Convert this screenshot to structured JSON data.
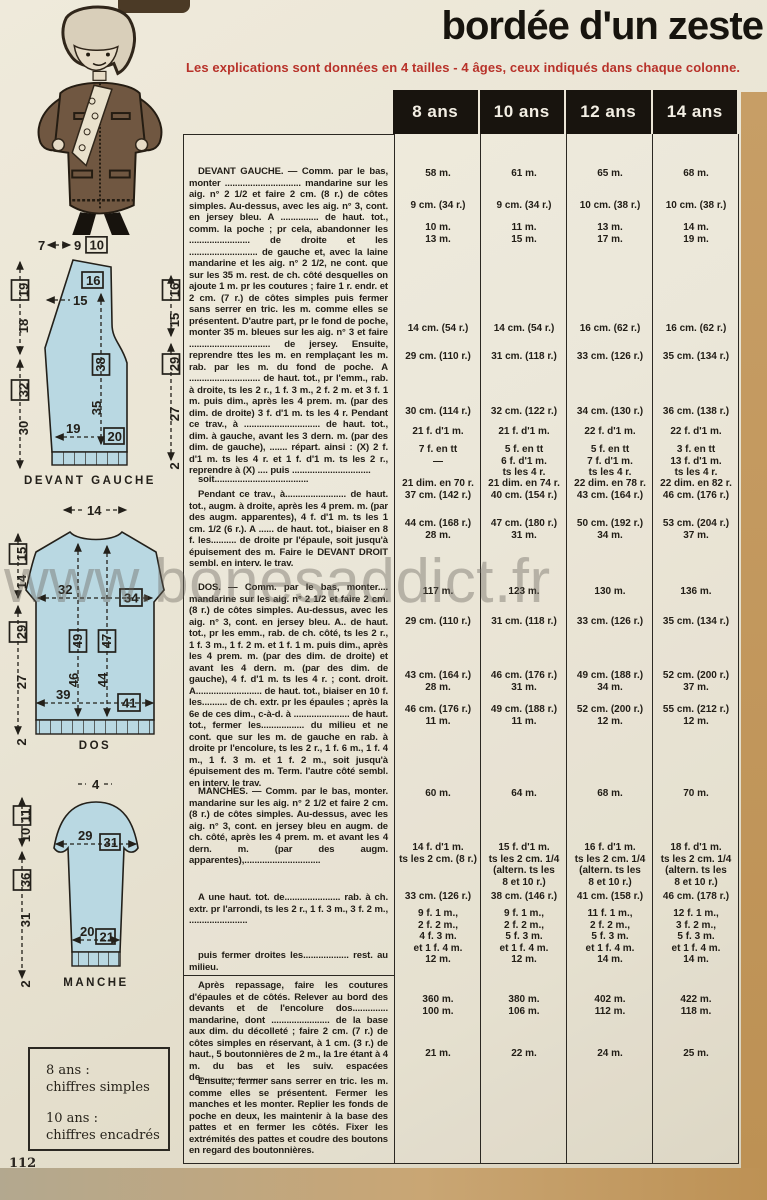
{
  "page": {
    "title": "bordée d'un zeste",
    "subtitle": "Les explications sont données en 4 tailles - 4 âges, ceux indiqués dans chaque colonne.",
    "page_number": "112",
    "watermark": "www.bonesaddict.fr",
    "colors": {
      "accent_red": "#b8322a",
      "header_bg": "#18140e",
      "diagram_blue": "#b9d8e2",
      "paper": "#e9e4d4"
    }
  },
  "table": {
    "headers": [
      "8 ans",
      "10 ans",
      "12 ans",
      "14 ans"
    ],
    "paragraphs": [
      {
        "top": 32,
        "text": "DEVANT GAUCHE. — Comm. par le bas, monter .............................. mandarine sur les aig. n° 2 1/2 et faire 2 cm. (8 r.) de côtes simples. Au-dessus, avec les aig. n° 3, cont. en jersey bleu. A ............... de haut. tot., comm. la poche ; pr cela, abandonner les ........................ de droite et les ........................... de gauche et, avec la laine mandarine et les aig. n° 2 1/2, ne cont. que sur les 35 m. rest. de ch. côté desquelles on ajoute 1 m. pr les coutures ; faire 1 r. endr. et 2 cm. (7 r.) de côtes simples puis fermer sans serrer en tric. les m. comme elles se présentent. D'autre part, pr le fond de poche, monter 35 m. bleues sur les aig. n° 3 et faire ................................ de jersey. Ensuite, reprendre ttes les m. en remplaçant les m. rab. par les m. du fond de poche. A ............................ de haut. tot., pr l'emm., rab. à droite, ts les 2 r., 1 f. 3 m., 2 f. 2 m. et 3 f. 1 m. puis dim., après les 4 prem. m. (par des dim. de droite) 3 f. d'1 m. ts les 4 r. Pendant ce trav., à .............................. de haut. tot., dim. à gauche, avant les 3 dern. m. (par des dim. de gauche), ....... répart. ainsi : (X) 2 f. d'1 m. ts les 4 r. et 1 f. d'1 m. ts les 2 r., reprendre à (X) .... puis ..............................."
      },
      {
        "top": 340,
        "text": "soit....................................."
      },
      {
        "top": 355,
        "text": "Pendant ce trav., à........................ de haut. tot., augm. à droite, après les 4 prem. m. (par des augm. apparentes), 4 f. d'1 m. ts les 1 cm. 1/2 (6 r.). A ...... de haut. tot., biaiser en 8 f. les.......... de droite pr l'épaule, soit jusqu'à épuisement des m. Faire le DEVANT DROIT sembl. en interv. le trav."
      },
      {
        "top": 448,
        "text": "DOS. — Comm. par le bas, monter.... mandarine sur les aig. n° 2 1/2 et faire 2 cm. (8 r.) de côtes simples. Au-dessus, avec les aig. n° 3, cont. en jersey bleu. A.. de haut. tot., pr les emm., rab. de ch. côté, ts les 2 r., 1 f. 3 m., 1 f. 2 m. et 1 f. 1 m. puis dim., après les 4 prem. m. (par des dim. de droite) et avant les 4 dern. m. (par des dim. de gauche), 4 f. d'1 m. ts les 4 r. ; cont. droit. A.......................... de haut. tot., biaiser en 10 f. les.......... de ch. extr. pr les épaules ; après la 6e de ces dim., c-à-d. à ...................... de haut. tot., fermer les................. du milieu et ne cont. que sur les m. de gauche en rab. à droite pr l'encolure, ts les 2 r., 1 f. 6 m., 1 f. 4 m., 1 f. 3 m. et 1 f. 2 m., soit jusqu'à épuisement des m. Term. l'autre côté sembl. en interv. le trav."
      },
      {
        "top": 652,
        "text": "MANCHES. — Comm. par le bas, monter. mandarine sur les aig. n° 2 1/2 et faire 2 cm. (8 r.) de côtes simples. Au-dessus, avec les aig. n° 3, cont. en jersey bleu en augm. de ch. côté, après les 4 prem. m. et avant les 4 dern. m. (par des augm. apparentes),.............................."
      },
      {
        "top": 758,
        "text": "A une haut. tot. de...................... rab. à ch. extr. pr l'arrondi, ts les 2 r., 1 f. 3 m., 3 f. 2 m., ......................."
      },
      {
        "top": 816,
        "text": "puis fermer droites les.................. rest. au milieu."
      },
      {
        "top": 846,
        "text": "Après repassage, faire les coutures d'épaules et de côtés. Relever au bord des devants et de l'encolure dos.............. mandarine, dont ....................... de la base aux dim. du décolleté ; faire 2 cm. (7 r.) de côtes simples en réservant, à 1 cm. (3 r.) de haut., 5 boutonnières de 2 m., la 1re étant à 4 m. du bas et les suiv. espacées de..........................."
      },
      {
        "top": 942,
        "text": "Ensuite, fermer sans serrer en tric. les m. comme elles se présentent. Fermer les manches et les monter. Replier les fonds de poche en deux, les maintenir à la base des pattes et en fermer les côtés. Fixer les extrémités des pattes et coudre des boutons en regard des boutonnières."
      }
    ],
    "divider_top": 841,
    "value_rows": [
      {
        "top": 34,
        "values": [
          "58 m.",
          "61 m.",
          "65 m.",
          "68 m."
        ]
      },
      {
        "top": 66,
        "values": [
          "9 cm. (34 r.)",
          "9 cm. (34 r.)",
          "10 cm. (38 r.)",
          "10 cm. (38 r.)"
        ]
      },
      {
        "top": 88,
        "values": [
          "10 m.\n13 m.",
          "11 m.\n15 m.",
          "13 m.\n17 m.",
          "14 m.\n19 m."
        ]
      },
      {
        "top": 189,
        "values": [
          "14 cm. (54 r.)",
          "14 cm. (54 r.)",
          "16 cm. (62 r.)",
          "16 cm. (62 r.)"
        ]
      },
      {
        "top": 217,
        "values": [
          "29 cm. (110 r.)",
          "31 cm. (118 r.)",
          "33 cm. (126 r.)",
          "35 cm. (134 r.)"
        ]
      },
      {
        "top": 272,
        "values": [
          "30 cm. (114 r.)",
          "32 cm. (122 r.)",
          "34 cm. (130 r.)",
          "36 cm. (138 r.)"
        ]
      },
      {
        "top": 292,
        "values": [
          "21 f. d'1 m.",
          "21 f. d'1 m.",
          "22 f. d'1 m.",
          "22 f. d'1 m."
        ]
      },
      {
        "top": 310,
        "values": [
          "7 f. en tt\n—",
          "5 f. en tt\n6 f. d'1 m.\nts les 4 r.",
          "5 f. en tt\n7 f. d'1 m.\nts les 4 r.",
          "3 f. en tt\n13 f. d'1 m.\nts les 4 r."
        ]
      },
      {
        "top": 344,
        "values": [
          "21 dim. en 70 r.\n37 cm. (142 r.)",
          "21 dim. en 74 r.\n40 cm. (154 r.)",
          "22 dim. en 78 r.\n43 cm. (164 r.)",
          "22 dim. en 82 r.\n46 cm. (176 r.)"
        ]
      },
      {
        "top": 384,
        "values": [
          "44 cm. (168 r.)\n28 m.",
          "47 cm. (180 r.)\n31 m.",
          "50 cm. (192 r.)\n34 m.",
          "53 cm. (204 r.)\n37 m."
        ]
      },
      {
        "top": 452,
        "values": [
          "117 m.",
          "123 m.",
          "130 m.",
          "136 m."
        ]
      },
      {
        "top": 482,
        "values": [
          "29 cm. (110 r.)",
          "31 cm. (118 r.)",
          "33 cm. (126 r.)",
          "35 cm. (134 r.)"
        ]
      },
      {
        "top": 536,
        "values": [
          "43 cm. (164 r.)\n28 m.",
          "46 cm. (176 r.)\n31 m.",
          "49 cm. (188 r.)\n34 m.",
          "52 cm. (200 r.)\n37 m."
        ]
      },
      {
        "top": 570,
        "values": [
          "46 cm. (176 r.)\n11 m.",
          "49 cm. (188 r.)\n11 m.",
          "52 cm. (200 r.)\n12 m.",
          "55 cm. (212 r.)\n12 m."
        ]
      },
      {
        "top": 654,
        "values": [
          "60 m.",
          "64 m.",
          "68 m.",
          "70 m."
        ]
      },
      {
        "top": 708,
        "values": [
          "14 f. d'1 m.\nts les 2 cm. (8 r.)",
          "15 f. d'1 m.\nts les 2 cm. 1/4\n(altern. ts les\n8 et 10 r.)",
          "16 f. d'1 m.\nts les 2 cm. 1/4\n(altern. ts les\n8 et 10 r.)",
          "18 f. d'1 m.\nts les 2 cm. 1/4\n(altern. ts les\n8 et 10 r.)"
        ]
      },
      {
        "top": 757,
        "values": [
          "33 cm. (126 r.)",
          "38 cm. (146 r.)",
          "41 cm. (158 r.)",
          "46 cm. (178 r.)"
        ]
      },
      {
        "top": 774,
        "values": [
          "9 f. 1 m.,\n2 f. 2 m.,\n4 f. 3 m.\net 1 f. 4 m.\n12 m.",
          "9 f. 1 m.,\n2 f. 2 m.,\n5 f. 3 m.\net 1 f. 4 m.\n12 m.",
          "11 f. 1 m.,\n2 f. 2 m.,\n5 f. 3 m.\net 1 f. 4 m.\n14 m.",
          "12 f. 1 m.,\n3 f. 2 m.,\n5 f. 3 m.\net 1 f. 4 m.\n14 m."
        ]
      },
      {
        "top": 860,
        "values": [
          "360 m.\n100 m.",
          "380 m.\n106 m.",
          "402 m.\n112 m.",
          "422 m.\n118 m."
        ]
      },
      {
        "top": 914,
        "values": [
          "21 m.",
          "22 m.",
          "24 m.",
          "25 m."
        ]
      }
    ]
  },
  "diagrams": {
    "devant_gauche": {
      "label": "DEVANT GAUCHE",
      "top_plain": "7",
      "top_plain2": "9",
      "top_boxed": "10",
      "left_upper_boxed": "19",
      "left_upper_plain": "18",
      "left_lower_boxed": "32",
      "left_lower_plain": "30",
      "inner_top_boxed": "16",
      "neck_plain": "15",
      "right_upper_boxed": "16",
      "right_upper_plain": "15",
      "right_lower_boxed": "29",
      "right_lower_plain": "27",
      "right_bottom_plain": "2",
      "center_boxed": "38",
      "center_plain": "35",
      "bottom_plain": "19",
      "bottom_boxed": "20"
    },
    "dos": {
      "label": "DOS",
      "top_plain": "14",
      "left_upper_boxed": "15",
      "left_upper_plain": "14",
      "left_lower_boxed": "29",
      "left_lower_plain": "27",
      "left_bottom_plain": "2",
      "chest_plain": "32",
      "chest_boxed": "34",
      "height_left_boxed": "49",
      "height_left_plain": "46",
      "height_right_boxed": "47",
      "height_right_plain": "44",
      "bottom_plain": "39",
      "bottom_boxed": "41"
    },
    "manche": {
      "label": "MANCHE",
      "top_plain": "4",
      "left_upper_boxed": "11",
      "left_upper_plain": "10",
      "left_lower_boxed": "36",
      "left_lower_plain": "31",
      "left_bottom_plain": "2",
      "upper_plain": "29",
      "upper_boxed": "31",
      "lower_plain": "20",
      "lower_boxed": "21"
    }
  },
  "legend": {
    "line1_size": "8 ans :",
    "line1_desc": "chiffres simples",
    "line2_size": "10 ans :",
    "line2_desc": "chiffres encadrés"
  }
}
